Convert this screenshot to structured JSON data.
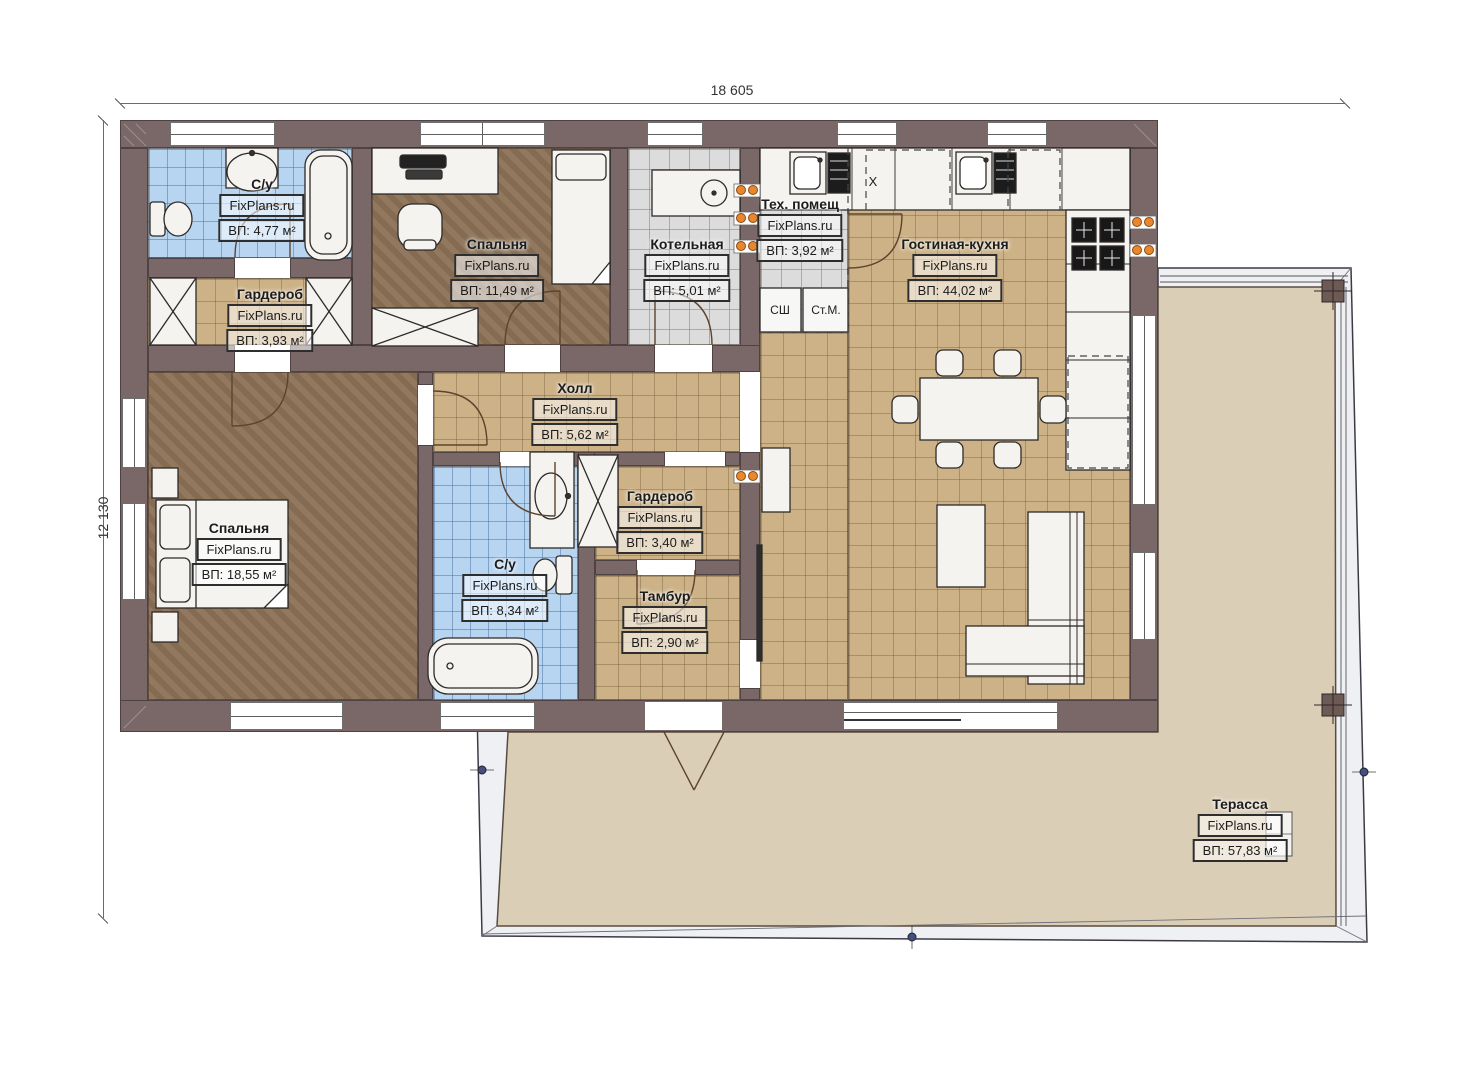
{
  "watermark": "FixPlans.ru",
  "dimensions": {
    "width": "18 605",
    "height": "12 130"
  },
  "rooms": [
    {
      "key": "wc1",
      "name": "С/у",
      "area": "ВП: 4,77 м²"
    },
    {
      "key": "wardrobe1",
      "name": "Гардероб",
      "area": "ВП: 3,93 м²"
    },
    {
      "key": "bedroom1",
      "name": "Спальня",
      "area": "ВП: 11,49 м²"
    },
    {
      "key": "boiler",
      "name": "Котельная",
      "area": "ВП: 5,01 м²"
    },
    {
      "key": "tech",
      "name": "Тех. помещ",
      "area": "ВП: 3,92 м²"
    },
    {
      "key": "living",
      "name": "Гостиная-кухня",
      "area": "ВП: 44,02 м²"
    },
    {
      "key": "hall",
      "name": "Холл",
      "area": "ВП: 5,62 м²"
    },
    {
      "key": "wardrobe2",
      "name": "Гардероб",
      "area": "ВП: 3,40 м²"
    },
    {
      "key": "bedroom2",
      "name": "Спальня",
      "area": "ВП: 18,55 м²"
    },
    {
      "key": "wc2",
      "name": "С/у",
      "area": "ВП: 8,34 м²"
    },
    {
      "key": "vestibule",
      "name": "Тамбур",
      "area": "ВП: 2,90 м²"
    },
    {
      "key": "terrace",
      "name": "Терасса",
      "area": "ВП: 57,83 м²"
    }
  ],
  "appliance_labels": {
    "dryer": "СШ",
    "washer": "Ст.М.",
    "counter_x": "X"
  },
  "colors": {
    "wall": "#7a6768",
    "floor_tan": "#cdb287",
    "floor_blue": "#b7d5f1",
    "floor_gray": "#dcdcdc",
    "floor_wood": "#8b7156",
    "terrace": "#dbceb7",
    "radiator": "#e8872e"
  }
}
